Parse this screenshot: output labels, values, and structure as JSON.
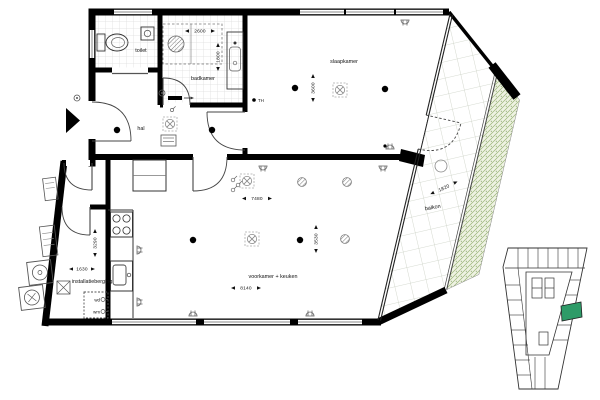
{
  "floorplan": {
    "rooms": {
      "toilet": "toilet",
      "badkamer": "badkamer",
      "slaapkamer": "slaapkamer",
      "hal": "hal",
      "voorkamer": "voorkamer + keuken",
      "berging": "installatieberging",
      "balkon": "balkon"
    },
    "dims": {
      "d2600": "2600",
      "d1800": "1800",
      "d3600": "3600",
      "d7480": "7480",
      "d3530": "3530",
      "d8140": "8140",
      "d1630": "1630",
      "d3290": "3290",
      "d1820": "1820"
    },
    "labels": {
      "th": "TH",
      "wd": "wd",
      "wm": "wm"
    },
    "colors": {
      "wall": "#000000",
      "planting": "#9ab477",
      "keymap_highlight": "#2e9b68"
    }
  }
}
